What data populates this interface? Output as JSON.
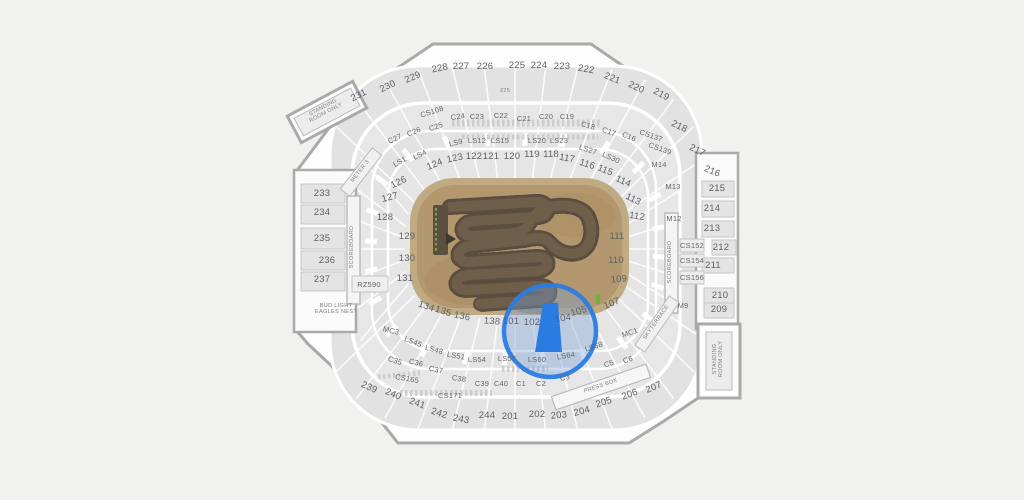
{
  "map": {
    "kind": "stadium-seating-map",
    "event_overlay": "supercross-dirt-track",
    "colors": {
      "page_bg": "#f1f1ef",
      "stadium_fill": "#fdfdfd",
      "stadium_stroke": "#a9a9a9",
      "band_fill": "#e3e3e3",
      "club_fill": "#e7e7e7",
      "field_tan": "#b59b74",
      "field_rim": "#c0aa83",
      "track_brown": "#6e5d49",
      "track_edge": "#4d4236",
      "gate_green": "#7aa93c",
      "highlight_blue": "#2b7ce2",
      "highlight_tint": "rgba(120,160,215,0.38)",
      "label_gray": "#5d6166"
    },
    "highlight": {
      "selected_section": "103",
      "circle": {
        "cx": 550,
        "cy": 331,
        "r": 46
      }
    },
    "labels": [
      {
        "t": "231",
        "x": 359,
        "y": 96,
        "r": -27,
        "c": "",
        "k": "s"
      },
      {
        "t": "230",
        "x": 388,
        "y": 87,
        "r": -26,
        "c": "",
        "k": "s"
      },
      {
        "t": "229",
        "x": 413,
        "y": 78,
        "r": -24,
        "c": "",
        "k": "s"
      },
      {
        "t": "228",
        "x": 440,
        "y": 69,
        "r": -12,
        "c": "",
        "k": "s"
      },
      {
        "t": "227",
        "x": 461,
        "y": 67,
        "r": 0,
        "c": "",
        "k": "s"
      },
      {
        "t": "226",
        "x": 485,
        "y": 67,
        "r": 0,
        "c": "",
        "k": "s"
      },
      {
        "t": "225",
        "x": 517,
        "y": 66,
        "r": 0,
        "c": "",
        "k": "s"
      },
      {
        "t": "224",
        "x": 539,
        "y": 66,
        "r": 0,
        "c": "",
        "k": "s"
      },
      {
        "t": "223",
        "x": 562,
        "y": 67,
        "r": 0,
        "c": "",
        "k": "s"
      },
      {
        "t": "222",
        "x": 586,
        "y": 70,
        "r": 10,
        "c": "",
        "k": "s"
      },
      {
        "t": "221",
        "x": 612,
        "y": 79,
        "r": 22,
        "c": "",
        "k": "s"
      },
      {
        "t": "220",
        "x": 636,
        "y": 88,
        "r": 26,
        "c": "",
        "k": "s"
      },
      {
        "t": "219",
        "x": 661,
        "y": 95,
        "r": 28,
        "c": "",
        "k": "s"
      },
      {
        "t": "225",
        "x": 505,
        "y": 92,
        "r": 0,
        "c": "xs",
        "k": "l"
      },
      {
        "t": "CS108",
        "x": 432,
        "y": 112,
        "r": -18,
        "c": "sm",
        "k": "s"
      },
      {
        "t": "C24",
        "x": 458,
        "y": 117,
        "r": -8,
        "c": "sm",
        "k": "s"
      },
      {
        "t": "C23",
        "x": 477,
        "y": 117,
        "r": 0,
        "c": "sm",
        "k": "s"
      },
      {
        "t": "C22",
        "x": 501,
        "y": 116,
        "r": 0,
        "c": "sm",
        "k": "s"
      },
      {
        "t": "C21",
        "x": 524,
        "y": 119,
        "r": 0,
        "c": "sm",
        "k": "s"
      },
      {
        "t": "C20",
        "x": 546,
        "y": 117,
        "r": 0,
        "c": "sm",
        "k": "s"
      },
      {
        "t": "C19",
        "x": 567,
        "y": 117,
        "r": 0,
        "c": "sm",
        "k": "s"
      },
      {
        "t": "C18",
        "x": 588,
        "y": 126,
        "r": 16,
        "c": "sm",
        "k": "s"
      },
      {
        "t": "C17",
        "x": 609,
        "y": 132,
        "r": 20,
        "c": "sm",
        "k": "s"
      },
      {
        "t": "C16",
        "x": 629,
        "y": 137,
        "r": 22,
        "c": "sm",
        "k": "s"
      },
      {
        "t": "CS137",
        "x": 651,
        "y": 136,
        "r": 20,
        "c": "sm",
        "k": "s"
      },
      {
        "t": "C25",
        "x": 436,
        "y": 127,
        "r": -20,
        "c": "sm",
        "k": "s"
      },
      {
        "t": "C26",
        "x": 414,
        "y": 132,
        "r": -22,
        "c": "sm",
        "k": "s"
      },
      {
        "t": "C27",
        "x": 395,
        "y": 139,
        "r": -25,
        "c": "sm",
        "k": "s"
      },
      {
        "t": "LS1",
        "x": 400,
        "y": 162,
        "r": -30,
        "c": "sm",
        "k": "s"
      },
      {
        "t": "LS4",
        "x": 420,
        "y": 155,
        "r": -26,
        "c": "sm",
        "k": "s"
      },
      {
        "t": "LS9",
        "x": 456,
        "y": 143,
        "r": -14,
        "c": "sm",
        "k": "s"
      },
      {
        "t": "LS12",
        "x": 477,
        "y": 141,
        "r": 0,
        "c": "sm",
        "k": "s"
      },
      {
        "t": "LS15",
        "x": 500,
        "y": 141,
        "r": 0,
        "c": "sm",
        "k": "s"
      },
      {
        "t": "LS20",
        "x": 537,
        "y": 141,
        "r": 0,
        "c": "sm",
        "k": "s"
      },
      {
        "t": "LS23",
        "x": 559,
        "y": 141,
        "r": 0,
        "c": "sm",
        "k": "s"
      },
      {
        "t": "LS27",
        "x": 588,
        "y": 150,
        "r": 18,
        "c": "sm",
        "k": "s"
      },
      {
        "t": "LS30",
        "x": 611,
        "y": 158,
        "r": 24,
        "c": "sm",
        "k": "s"
      },
      {
        "t": "CS139",
        "x": 660,
        "y": 149,
        "r": 20,
        "c": "sm",
        "k": "s"
      },
      {
        "t": "M14",
        "x": 659,
        "y": 165,
        "r": 0,
        "c": "sm",
        "k": "s"
      },
      {
        "t": "M13",
        "x": 673,
        "y": 187,
        "r": 0,
        "c": "sm",
        "k": "s"
      },
      {
        "t": "M12",
        "x": 674,
        "y": 219,
        "r": 0,
        "c": "sm",
        "k": "s"
      },
      {
        "t": "CS152",
        "x": 692,
        "y": 246,
        "r": 0,
        "c": "sm",
        "k": "s"
      },
      {
        "t": "CS154",
        "x": 692,
        "y": 261,
        "r": 0,
        "c": "sm",
        "k": "s"
      },
      {
        "t": "CS156",
        "x": 692,
        "y": 278,
        "r": 0,
        "c": "sm",
        "k": "s"
      },
      {
        "t": "M9",
        "x": 683,
        "y": 306,
        "r": 0,
        "c": "sm",
        "k": "s"
      },
      {
        "t": "MC1",
        "x": 630,
        "y": 333,
        "r": -18,
        "c": "sm",
        "k": "s"
      },
      {
        "t": "MC3",
        "x": 391,
        "y": 331,
        "r": 14,
        "c": "sm",
        "k": "s"
      },
      {
        "t": "124",
        "x": 435,
        "y": 165,
        "r": -22,
        "c": "",
        "k": "s"
      },
      {
        "t": "123",
        "x": 455,
        "y": 159,
        "r": -12,
        "c": "",
        "k": "s"
      },
      {
        "t": "122",
        "x": 474,
        "y": 157,
        "r": 0,
        "c": "",
        "k": "s"
      },
      {
        "t": "121",
        "x": 491,
        "y": 157,
        "r": 0,
        "c": "",
        "k": "s"
      },
      {
        "t": "120",
        "x": 512,
        "y": 157,
        "r": 0,
        "c": "",
        "k": "s"
      },
      {
        "t": "119",
        "x": 532,
        "y": 155,
        "r": 0,
        "c": "",
        "k": "s"
      },
      {
        "t": "118",
        "x": 551,
        "y": 155,
        "r": 0,
        "c": "",
        "k": "s"
      },
      {
        "t": "117",
        "x": 567,
        "y": 159,
        "r": 10,
        "c": "",
        "k": "s"
      },
      {
        "t": "116",
        "x": 587,
        "y": 165,
        "r": 18,
        "c": "",
        "k": "s"
      },
      {
        "t": "115",
        "x": 605,
        "y": 171,
        "r": 22,
        "c": "",
        "k": "s"
      },
      {
        "t": "114",
        "x": 623,
        "y": 182,
        "r": 24,
        "c": "",
        "k": "s"
      },
      {
        "t": "113",
        "x": 633,
        "y": 200,
        "r": 26,
        "c": "",
        "k": "s"
      },
      {
        "t": "112",
        "x": 637,
        "y": 217,
        "r": 8,
        "c": "",
        "k": "s"
      },
      {
        "t": "111",
        "x": 617,
        "y": 237,
        "r": 0,
        "c": "",
        "k": "s"
      },
      {
        "t": "110",
        "x": 616,
        "y": 261,
        "r": 0,
        "c": "",
        "k": "s"
      },
      {
        "t": "109",
        "x": 619,
        "y": 280,
        "r": -6,
        "c": "",
        "k": "s"
      },
      {
        "t": "107",
        "x": 612,
        "y": 304,
        "r": -22,
        "c": "",
        "k": "s"
      },
      {
        "t": "105",
        "x": 579,
        "y": 312,
        "r": -16,
        "c": "",
        "k": "s"
      },
      {
        "t": "104",
        "x": 563,
        "y": 319,
        "r": -8,
        "c": "",
        "k": "s"
      },
      {
        "t": "102",
        "x": 532,
        "y": 323,
        "r": 0,
        "c": "",
        "k": "s"
      },
      {
        "t": "101",
        "x": 511,
        "y": 322,
        "r": 0,
        "c": "",
        "k": "s"
      },
      {
        "t": "138",
        "x": 492,
        "y": 322,
        "r": 4,
        "c": "",
        "k": "s"
      },
      {
        "t": "136",
        "x": 462,
        "y": 317,
        "r": 12,
        "c": "",
        "k": "s"
      },
      {
        "t": "135",
        "x": 443,
        "y": 312,
        "r": 18,
        "c": "",
        "k": "s"
      },
      {
        "t": "134",
        "x": 426,
        "y": 307,
        "r": 20,
        "c": "",
        "k": "s"
      },
      {
        "t": "126",
        "x": 399,
        "y": 183,
        "r": -26,
        "c": "",
        "k": "s"
      },
      {
        "t": "127",
        "x": 390,
        "y": 198,
        "r": -14,
        "c": "",
        "k": "s"
      },
      {
        "t": "128",
        "x": 385,
        "y": 218,
        "r": 0,
        "c": "",
        "k": "s"
      },
      {
        "t": "129",
        "x": 407,
        "y": 237,
        "r": 0,
        "c": "",
        "k": "s"
      },
      {
        "t": "130",
        "x": 407,
        "y": 259,
        "r": 0,
        "c": "",
        "k": "s"
      },
      {
        "t": "131",
        "x": 405,
        "y": 279,
        "r": 0,
        "c": "",
        "k": "s"
      },
      {
        "t": "233",
        "x": 322,
        "y": 194,
        "r": 0,
        "c": "",
        "k": "s"
      },
      {
        "t": "234",
        "x": 322,
        "y": 213,
        "r": 0,
        "c": "",
        "k": "s"
      },
      {
        "t": "235",
        "x": 322,
        "y": 239,
        "r": 0,
        "c": "",
        "k": "s"
      },
      {
        "t": "236",
        "x": 327,
        "y": 261,
        "r": 0,
        "c": "",
        "k": "s"
      },
      {
        "t": "237",
        "x": 322,
        "y": 280,
        "r": 0,
        "c": "",
        "k": "s"
      },
      {
        "t": "RZ590",
        "x": 369,
        "y": 285,
        "r": 0,
        "c": "sm",
        "k": "s"
      },
      {
        "t": "SCOREBOARD",
        "x": 353,
        "y": 247,
        "r": -90,
        "c": "xs",
        "k": "l"
      },
      {
        "t": "SCOREBOARD",
        "x": 671,
        "y": 262,
        "r": -90,
        "c": "xs",
        "k": "l"
      },
      {
        "t": "BUD LIGHT\nEAGLES NEST",
        "x": 336,
        "y": 310,
        "r": 0,
        "c": "xs",
        "k": "l"
      },
      {
        "t": "METER 3",
        "x": 361,
        "y": 172,
        "r": -52,
        "c": "xs",
        "k": "l"
      },
      {
        "t": "SKYTERRACE",
        "x": 657,
        "y": 323,
        "r": -55,
        "c": "xs",
        "k": "l"
      },
      {
        "t": "PRESS BOX",
        "x": 601,
        "y": 387,
        "r": -19,
        "c": "xs",
        "k": "l"
      },
      {
        "t": "STANDING\nROOM ONLY",
        "x": 325,
        "y": 111,
        "r": -28,
        "c": "xs",
        "k": "l"
      },
      {
        "t": "STANDING\nROOM ONLY",
        "x": 719,
        "y": 359,
        "r": -90,
        "c": "xs",
        "k": "l"
      },
      {
        "t": "218",
        "x": 679,
        "y": 127,
        "r": 26,
        "c": "",
        "k": "s"
      },
      {
        "t": "217",
        "x": 697,
        "y": 151,
        "r": 26,
        "c": "",
        "k": "s"
      },
      {
        "t": "216",
        "x": 712,
        "y": 172,
        "r": 22,
        "c": "",
        "k": "s"
      },
      {
        "t": "215",
        "x": 717,
        "y": 189,
        "r": 0,
        "c": "",
        "k": "s"
      },
      {
        "t": "214",
        "x": 712,
        "y": 209,
        "r": 0,
        "c": "",
        "k": "s"
      },
      {
        "t": "213",
        "x": 712,
        "y": 229,
        "r": 0,
        "c": "",
        "k": "s"
      },
      {
        "t": "212",
        "x": 721,
        "y": 248,
        "r": 0,
        "c": "",
        "k": "s"
      },
      {
        "t": "211",
        "x": 713,
        "y": 266,
        "r": 0,
        "c": "",
        "k": "s"
      },
      {
        "t": "210",
        "x": 720,
        "y": 296,
        "r": 0,
        "c": "",
        "k": "s"
      },
      {
        "t": "209",
        "x": 719,
        "y": 310,
        "r": 0,
        "c": "",
        "k": "s"
      },
      {
        "t": "LS45",
        "x": 413,
        "y": 342,
        "r": 22,
        "c": "sm",
        "k": "s"
      },
      {
        "t": "LS48",
        "x": 434,
        "y": 350,
        "r": 16,
        "c": "sm",
        "k": "s"
      },
      {
        "t": "LS51",
        "x": 456,
        "y": 356,
        "r": 10,
        "c": "sm",
        "k": "s"
      },
      {
        "t": "LS54",
        "x": 477,
        "y": 360,
        "r": 0,
        "c": "sm",
        "k": "s"
      },
      {
        "t": "LS57",
        "x": 507,
        "y": 359,
        "r": 0,
        "c": "sm",
        "k": "s"
      },
      {
        "t": "LS60",
        "x": 537,
        "y": 360,
        "r": 0,
        "c": "sm",
        "k": "s"
      },
      {
        "t": "LS64",
        "x": 566,
        "y": 356,
        "r": -10,
        "c": "sm",
        "k": "s"
      },
      {
        "t": "LS68",
        "x": 594,
        "y": 347,
        "r": -18,
        "c": "sm",
        "k": "s"
      },
      {
        "t": "C35",
        "x": 395,
        "y": 361,
        "r": 18,
        "c": "sm",
        "k": "s"
      },
      {
        "t": "C36",
        "x": 416,
        "y": 363,
        "r": 14,
        "c": "sm",
        "k": "s"
      },
      {
        "t": "C37",
        "x": 436,
        "y": 370,
        "r": 12,
        "c": "sm",
        "k": "s"
      },
      {
        "t": "C38",
        "x": 459,
        "y": 379,
        "r": 8,
        "c": "sm",
        "k": "s"
      },
      {
        "t": "C39",
        "x": 482,
        "y": 384,
        "r": 0,
        "c": "sm",
        "k": "s"
      },
      {
        "t": "C40",
        "x": 501,
        "y": 384,
        "r": 0,
        "c": "sm",
        "k": "s"
      },
      {
        "t": "C1",
        "x": 521,
        "y": 384,
        "r": 0,
        "c": "sm",
        "k": "s"
      },
      {
        "t": "C2",
        "x": 541,
        "y": 384,
        "r": 0,
        "c": "sm",
        "k": "s"
      },
      {
        "t": "C3",
        "x": 565,
        "y": 378,
        "r": -12,
        "c": "sm",
        "k": "s"
      },
      {
        "t": "C5",
        "x": 609,
        "y": 364,
        "r": -18,
        "c": "sm",
        "k": "s"
      },
      {
        "t": "C6",
        "x": 628,
        "y": 360,
        "r": -18,
        "c": "sm",
        "k": "s"
      },
      {
        "t": "CS165",
        "x": 407,
        "y": 379,
        "r": 10,
        "c": "sm",
        "k": "s"
      },
      {
        "t": "CS171",
        "x": 450,
        "y": 396,
        "r": 0,
        "c": "sm",
        "k": "s"
      },
      {
        "t": "239",
        "x": 369,
        "y": 388,
        "r": 24,
        "c": "",
        "k": "s"
      },
      {
        "t": "240",
        "x": 393,
        "y": 395,
        "r": 22,
        "c": "",
        "k": "s"
      },
      {
        "t": "241",
        "x": 417,
        "y": 404,
        "r": 20,
        "c": "",
        "k": "s"
      },
      {
        "t": "242",
        "x": 439,
        "y": 414,
        "r": 18,
        "c": "",
        "k": "s"
      },
      {
        "t": "243",
        "x": 461,
        "y": 420,
        "r": 10,
        "c": "",
        "k": "s"
      },
      {
        "t": "244",
        "x": 487,
        "y": 416,
        "r": 0,
        "c": "",
        "k": "s"
      },
      {
        "t": "201",
        "x": 510,
        "y": 417,
        "r": 0,
        "c": "",
        "k": "s"
      },
      {
        "t": "202",
        "x": 537,
        "y": 415,
        "r": 0,
        "c": "",
        "k": "s"
      },
      {
        "t": "203",
        "x": 559,
        "y": 416,
        "r": -6,
        "c": "",
        "k": "s"
      },
      {
        "t": "204",
        "x": 582,
        "y": 412,
        "r": -14,
        "c": "",
        "k": "s"
      },
      {
        "t": "205",
        "x": 604,
        "y": 403,
        "r": -18,
        "c": "",
        "k": "s"
      },
      {
        "t": "206",
        "x": 630,
        "y": 395,
        "r": -20,
        "c": "",
        "k": "s"
      },
      {
        "t": "207",
        "x": 654,
        "y": 388,
        "r": -22,
        "c": "",
        "k": "s"
      }
    ]
  }
}
